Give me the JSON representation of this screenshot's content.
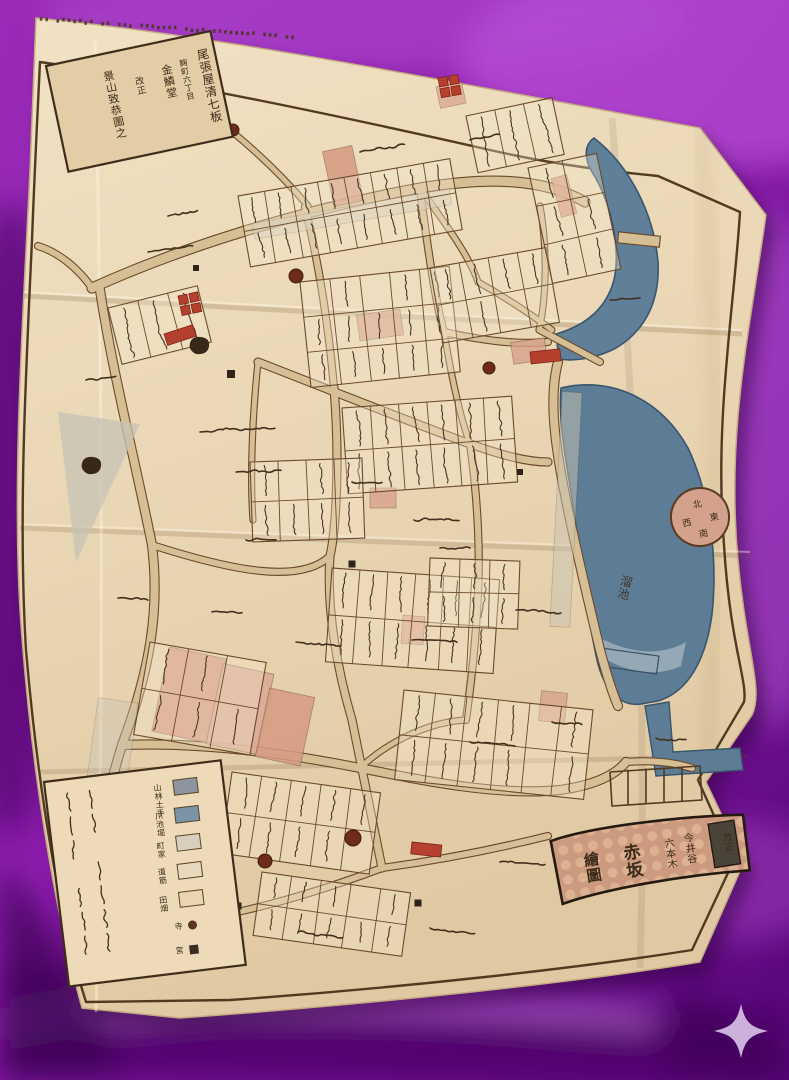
{
  "photo": {
    "subject": "folded Edo-period woodblock district map on purple satin cloth",
    "watermark_icon": "sparkle-icon"
  },
  "map": {
    "title_slip": {
      "seal": "改正",
      "columns": [
        "今井谷",
        "六本木",
        "赤坂",
        "繪圖"
      ]
    },
    "cartouche": {
      "columns": [
        "尾張屋清七板",
        "麹町六丁目",
        "金鱗堂",
        "改正",
        "景山致恭圖之"
      ]
    },
    "labels": {
      "pond": "溜池"
    },
    "compass": {
      "points": [
        "北",
        "東",
        "南",
        "西"
      ]
    },
    "legend": {
      "items": [
        {
          "swatch": "#8e959e",
          "label": "山林土手"
        },
        {
          "swatch": "#7b93a6",
          "label": "川池堀"
        },
        {
          "swatch": "#d6cfbf",
          "label": "町家"
        },
        {
          "swatch": "#e6d9bd",
          "label": "道筋"
        },
        {
          "swatch": "#e9d6b0",
          "label": "田畑"
        },
        {
          "marker": "dot",
          "label": "寺"
        },
        {
          "marker": "square",
          "label": "宮"
        }
      ]
    },
    "colors": {
      "satin_purple": "#8d1cad",
      "satin_highlight": "#c45fe0",
      "satin_shadow": "#4a0666",
      "paper": "#e9d6b4",
      "ink": "#3f2d1b",
      "street": "#d6bf94",
      "water": "#5d7c95",
      "temple_pink": "#d69a82",
      "seal_red": "#b5402e",
      "slip_ground": "#cc9a7e"
    }
  }
}
